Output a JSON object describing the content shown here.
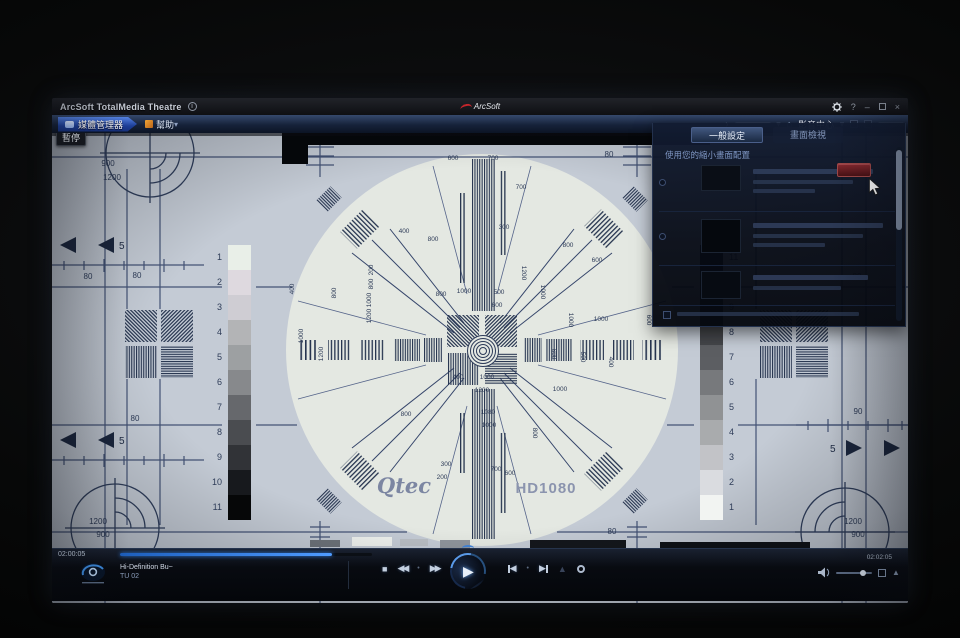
{
  "titlebar": {
    "app_title": "ArcSoft TotalMedia Theatre",
    "logo": "ArcSoft"
  },
  "icons": {
    "info": "i",
    "help": "?",
    "minimize": "–",
    "close": "×",
    "chevron_right": "›",
    "caret_down": "▾",
    "home": "⌂",
    "stop": "■",
    "rewind": "◀◀",
    "fast_forward": "▶▶",
    "play": "▶",
    "prev_tri": "◀",
    "next_tri": "▶",
    "eject": "▲",
    "dot": "•",
    "speaker_tri": "▲"
  },
  "toolbar": {
    "media_manager": "媒體管理器",
    "help": "幫助",
    "media_center": "影音中心"
  },
  "video": {
    "pause_tooltip": "暫停"
  },
  "panel": {
    "tab_general": "一般設定",
    "tab_view": "畫面檢視",
    "heading": "使用您的縮小畫面配置"
  },
  "pattern": {
    "brand": "Qtec",
    "format": "HD1080",
    "corner_tl": [
      "900",
      "1200"
    ],
    "corner_bl": [
      "1200",
      "900"
    ],
    "corner_br": [
      "1200",
      "900"
    ],
    "arrow_left_top": "5",
    "arrow_left_bottom": "5",
    "arrow_right": "5",
    "gray_left": [
      {
        "label": "1",
        "color": "#e9efe8"
      },
      {
        "label": "2",
        "color": "#ded9df"
      },
      {
        "label": "3",
        "color": "#cfcdd3"
      },
      {
        "label": "4",
        "color": "#b3b4b6"
      },
      {
        "label": "5",
        "color": "#9da0a2"
      },
      {
        "label": "6",
        "color": "#87898c"
      },
      {
        "label": "7",
        "color": "#66686c"
      },
      {
        "label": "8",
        "color": "#4a4c50"
      },
      {
        "label": "9",
        "color": "#313337"
      },
      {
        "label": "10",
        "color": "#17191d"
      },
      {
        "label": "11",
        "color": "#060708"
      }
    ],
    "gray_right": [
      {
        "label": "11",
        "color": "#0a0c10"
      },
      {
        "label": "10",
        "color": "#1a1c20"
      },
      {
        "label": "9",
        "color": "#2e3034"
      },
      {
        "label": "8",
        "color": "#44464a"
      },
      {
        "label": "7",
        "color": "#5c5e62"
      },
      {
        "label": "6",
        "color": "#77797c"
      },
      {
        "label": "5",
        "color": "#909294"
      },
      {
        "label": "4",
        "color": "#a9abad"
      },
      {
        "label": "3",
        "color": "#c2c3c7"
      },
      {
        "label": "2",
        "color": "#dadce0"
      },
      {
        "label": "1",
        "color": "#f2f4f2"
      }
    ],
    "ruler_labels": [
      {
        "x": 245,
        "y": 24,
        "t": "80"
      },
      {
        "x": 557,
        "y": 24,
        "t": "80"
      },
      {
        "x": 36,
        "y": 146,
        "t": "80"
      },
      {
        "x": 85,
        "y": 145,
        "t": "80"
      },
      {
        "x": 83,
        "y": 288,
        "t": "80"
      },
      {
        "x": 805,
        "y": 146,
        "t": "80"
      },
      {
        "x": 806,
        "y": 281,
        "t": "90"
      },
      {
        "x": 560,
        "y": 401,
        "t": "80"
      }
    ],
    "marks": [
      {
        "x": 401,
        "y": 27,
        "t": "600"
      },
      {
        "x": 441,
        "y": 27,
        "t": "700"
      },
      {
        "x": 469,
        "y": 56,
        "t": "700"
      },
      {
        "x": 452,
        "y": 96,
        "t": "300"
      },
      {
        "x": 352,
        "y": 100,
        "t": "400"
      },
      {
        "x": 381,
        "y": 108,
        "t": "800"
      },
      {
        "x": 412,
        "y": 160,
        "t": "1000"
      },
      {
        "x": 389,
        "y": 163,
        "t": "800"
      },
      {
        "x": 447,
        "y": 161,
        "t": "500"
      },
      {
        "x": 445,
        "y": 174,
        "t": "600"
      },
      {
        "x": 321,
        "y": 137,
        "t": "200",
        "r": -90
      },
      {
        "x": 321,
        "y": 151,
        "t": "800",
        "r": -90
      },
      {
        "x": 319,
        "y": 167,
        "t": "1000",
        "r": -90
      },
      {
        "x": 319,
        "y": 183,
        "t": "1200",
        "r": -90
      },
      {
        "x": 251,
        "y": 203,
        "t": "1000",
        "r": -90
      },
      {
        "x": 271,
        "y": 221,
        "t": "1200",
        "r": -90
      },
      {
        "x": 242,
        "y": 156,
        "t": "400",
        "r": -90
      },
      {
        "x": 284,
        "y": 160,
        "t": "800",
        "r": -90
      },
      {
        "x": 470,
        "y": 140,
        "t": "1200",
        "r": 90
      },
      {
        "x": 489,
        "y": 159,
        "t": "1000",
        "r": 90
      },
      {
        "x": 517,
        "y": 187,
        "t": "1000",
        "r": 90
      },
      {
        "x": 500,
        "y": 221,
        "t": "600",
        "r": 90
      },
      {
        "x": 529,
        "y": 224,
        "t": "500",
        "r": 90
      },
      {
        "x": 557,
        "y": 229,
        "t": "400",
        "r": 90
      },
      {
        "x": 595,
        "y": 187,
        "t": "600",
        "r": 90
      },
      {
        "x": 516,
        "y": 114,
        "t": "800"
      },
      {
        "x": 545,
        "y": 129,
        "t": "600"
      },
      {
        "x": 549,
        "y": 188,
        "t": "1000"
      },
      {
        "x": 406,
        "y": 246,
        "t": "400"
      },
      {
        "x": 435,
        "y": 246,
        "t": "1000"
      },
      {
        "x": 430,
        "y": 259,
        "t": "1200"
      },
      {
        "x": 436,
        "y": 281,
        "t": "1080"
      },
      {
        "x": 437,
        "y": 294,
        "t": "1000"
      },
      {
        "x": 394,
        "y": 333,
        "t": "300"
      },
      {
        "x": 390,
        "y": 346,
        "t": "200"
      },
      {
        "x": 444,
        "y": 338,
        "t": "700"
      },
      {
        "x": 458,
        "y": 342,
        "t": "600"
      },
      {
        "x": 508,
        "y": 258,
        "t": "1000"
      },
      {
        "x": 481,
        "y": 300,
        "t": "800",
        "r": 90
      },
      {
        "x": 354,
        "y": 283,
        "t": "800"
      }
    ]
  },
  "playback": {
    "elapsed": "02:00:05",
    "total": "02:02:05",
    "disc_line1": "Hi-Definition Bu~",
    "disc_line2": "TU 02",
    "progress_pct": 84
  }
}
